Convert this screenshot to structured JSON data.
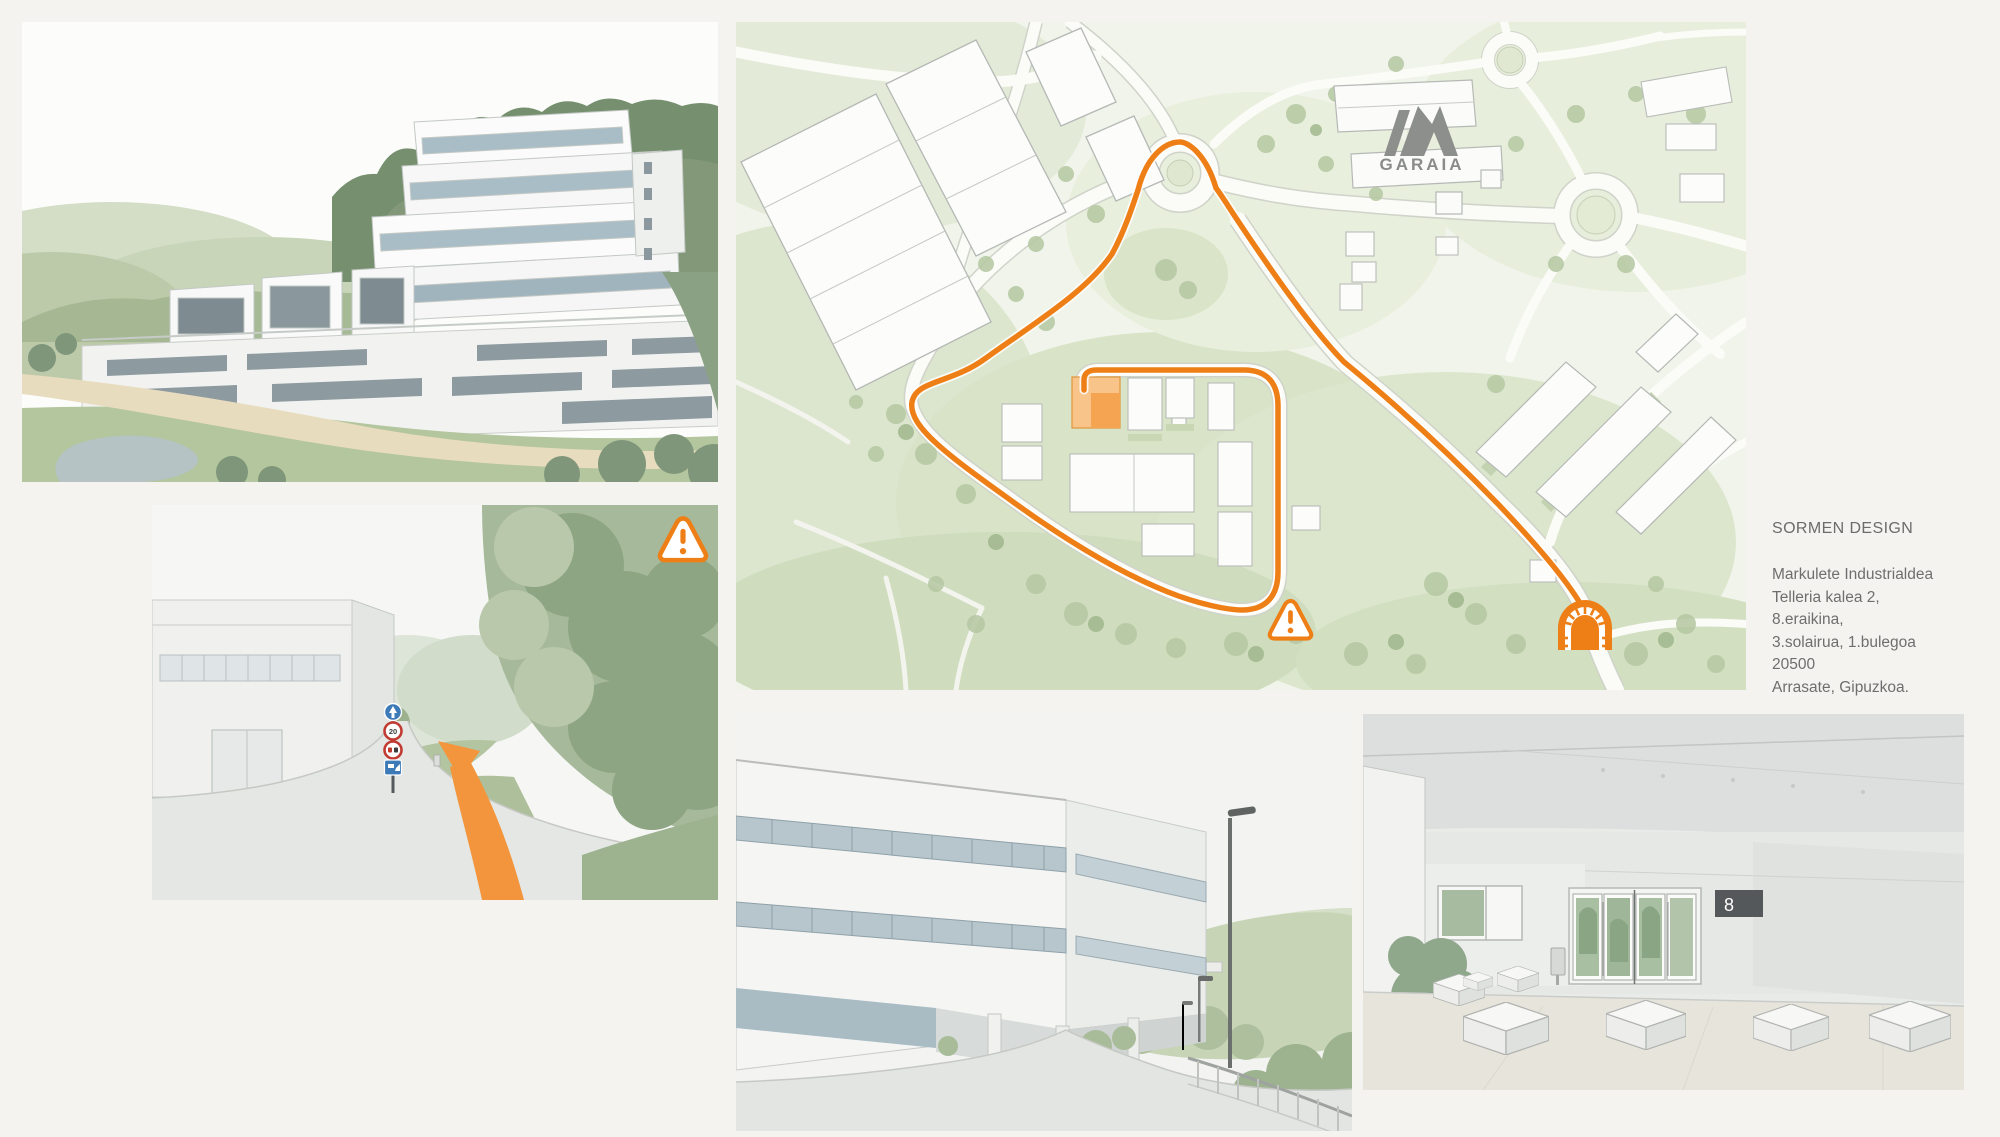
{
  "page": {
    "background_color": "#f5f3ef"
  },
  "contact": {
    "company": "SORMEN DESIGN",
    "address_lines": [
      "Markulete Industrialdea",
      "Telleria kalea 2,",
      "8.eraikina,",
      "3.solairua, 1.bulegoa",
      "20500",
      "Arrasate, Gipuzkoa."
    ]
  },
  "map": {
    "park_label": "GARAIA",
    "route_color": "#EE7F16",
    "destination_highlight_color": "#F6BE82"
  },
  "approach": {
    "speed_limit_sign": "20"
  },
  "entrance": {
    "building_sign": "8"
  },
  "icons": {
    "warning": "warning-triangle-icon",
    "tunnel": "tunnel-icon",
    "route_arrow": "route-arrow",
    "garaia_logo": "garaia-logo"
  }
}
